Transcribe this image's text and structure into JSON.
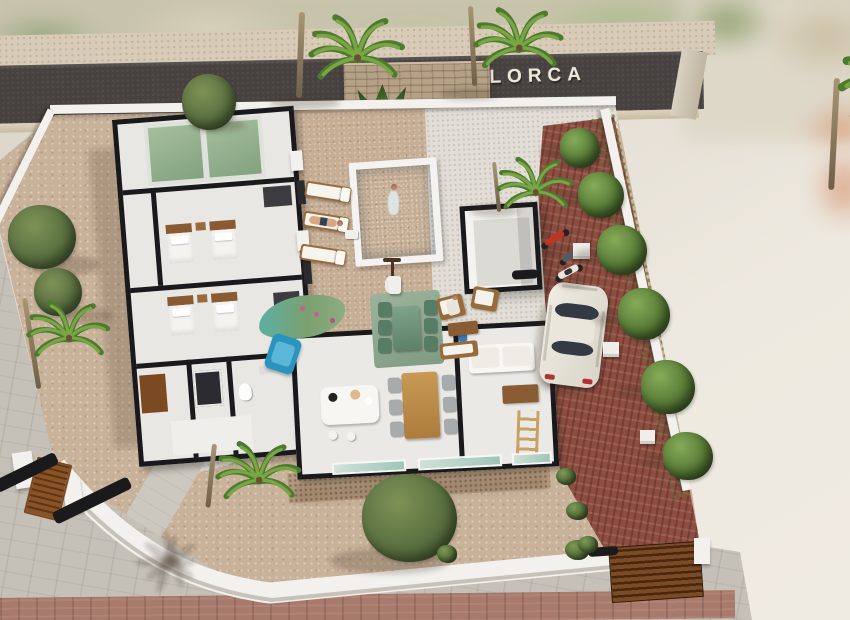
{
  "scene": {
    "type": "3d-architectural-render",
    "description": "Aerial 3D render of a single-storey villa plot with cutaway floor plan, swimming pool, gardens, red-brick driveway and street",
    "street_sign": "C/ MALLORCA"
  },
  "colors": {
    "road": "#474240",
    "sign_text": "#ece7d9",
    "gravel_beige": "#c9b29a",
    "gravel_white": "#e2ded7",
    "pool_deck": "#c6ae95",
    "pool_water": "#2fa9c6",
    "brick": "#8d4e41",
    "wall_white": "#f2f1ee",
    "wall_top": "#1a1a1c",
    "tree_green": "#5a7040",
    "hedge_green": "#567a36",
    "palm_green": "#79a644",
    "car_white": "#efece3",
    "bed_wood": "#8a5a33",
    "table_wood": "#c89a55",
    "outdoor_green": "#587d66",
    "glass_teal": "#9fc4b8",
    "gate_wood": "#7d4a26"
  },
  "inventory": {
    "pool": "rectangular pool with bather",
    "sun_loungers": 3,
    "people": 4,
    "palm_trees": 6,
    "hedge_trees": 6,
    "olive_trees": 3,
    "bushes": 5,
    "white_car": 1,
    "two_wheelers": 3,
    "bedrooms": 2,
    "single_beds": 4,
    "outdoor_dining_set": "green table with six chairs",
    "indoor_dining_set": "wooden table with six grey chairs",
    "sofa": "white sofa",
    "ladder": "wooden ladder against wall",
    "pool_house": "white storage room",
    "gates": [
      "wooden pedestrian gate",
      "wooden driveway gate"
    ],
    "stone_feature_wall": 1
  }
}
